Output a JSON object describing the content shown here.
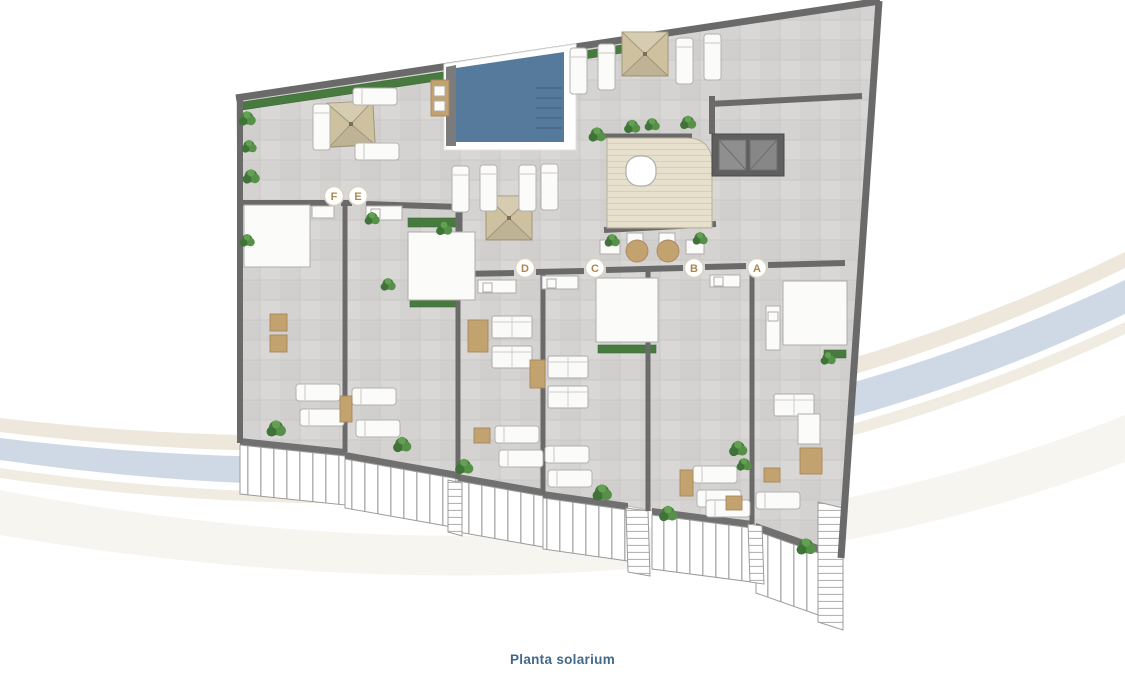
{
  "caption": {
    "text": "Planta solarium"
  },
  "markers": [
    {
      "label": "F"
    },
    {
      "label": "E"
    },
    {
      "label": "D"
    },
    {
      "label": "C"
    },
    {
      "label": "B"
    },
    {
      "label": "A"
    }
  ],
  "colors": {
    "caption": "#42698b",
    "floor": "#d5d3d1",
    "wall": "#6a6a6a",
    "pool": "#567a9c",
    "pool_dark": "#47688a",
    "deck": "#e7e0cd",
    "deck_line": "#d6cdb4",
    "parasol": "#cdc1a0",
    "plant": "#477a3e",
    "tan": "#c2a26f",
    "marker_text": "#ad8750",
    "marker_border": "#d9d1c2",
    "swoosh_blue": "#cfd9e5",
    "swoosh_beige": "#ece5d8"
  }
}
